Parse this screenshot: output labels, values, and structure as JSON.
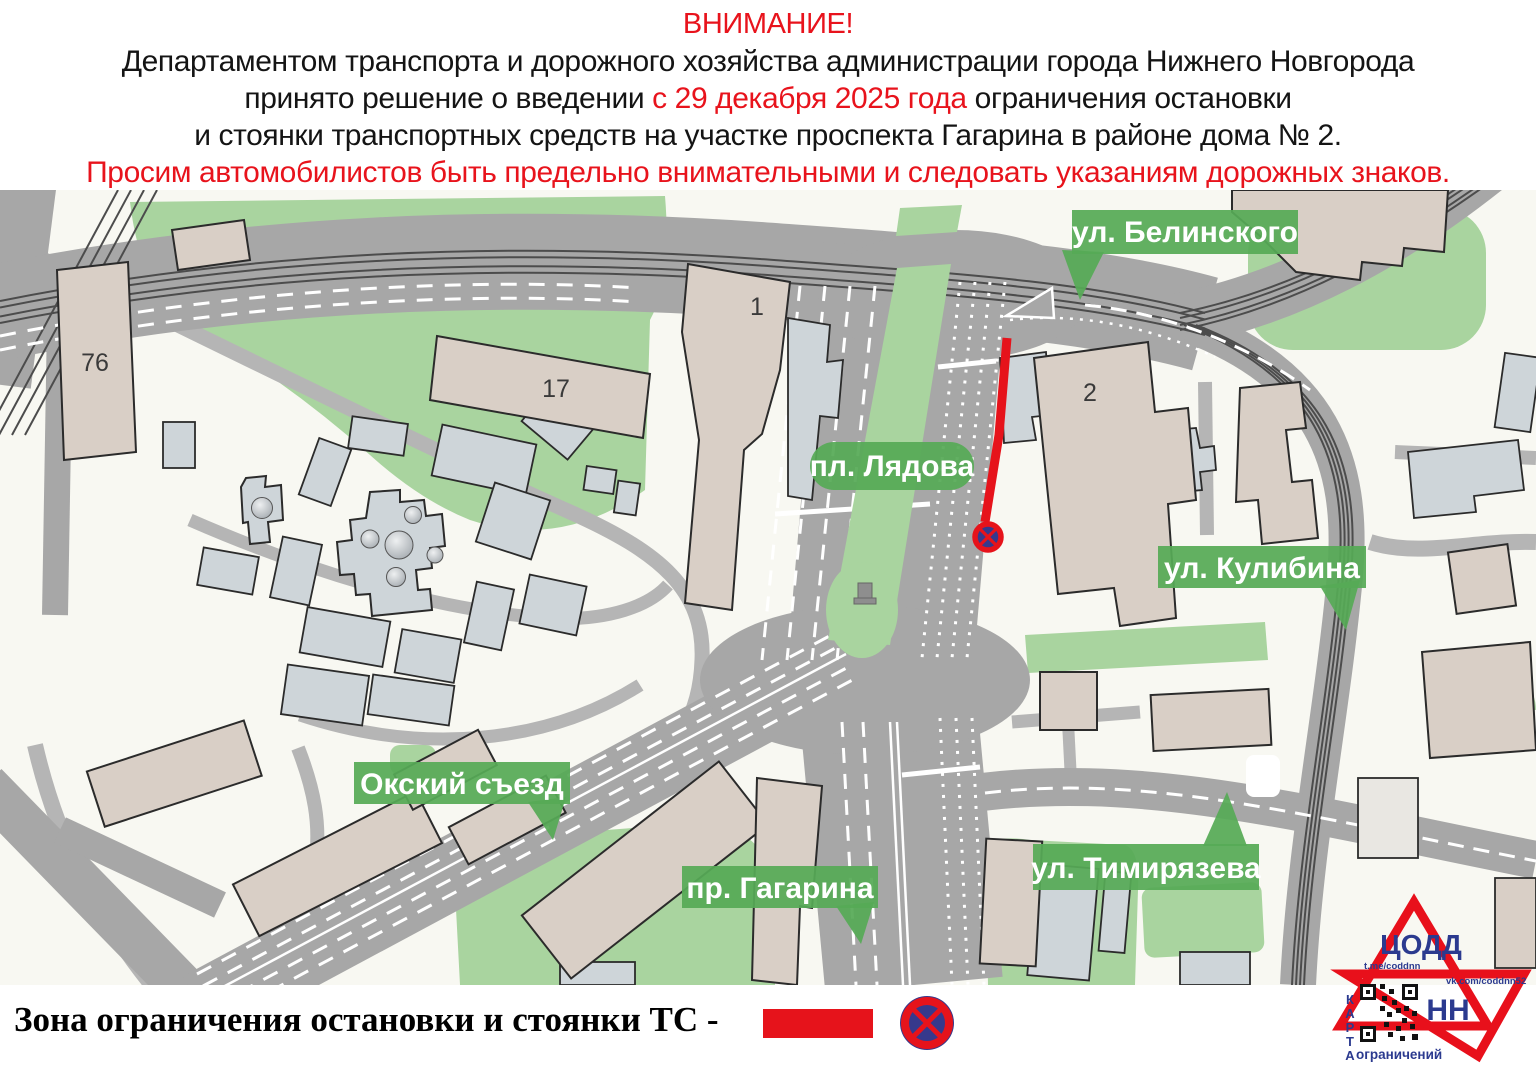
{
  "header": {
    "title": "ВНИМАНИЕ!",
    "line1": "Департаментом транспорта и дорожного хозяйства администрации города Нижнего Новгорода",
    "line2_before": "принято решение о введении ",
    "line2_red": "с 29 декабря 2025 года",
    "line2_after": " ограничения остановки",
    "line3": "и стоянки транспортных средств на участке проспекта Гагарина в районе дома № 2.",
    "line4": "Просим автомобилистов быть предельно внимательными и следовать указаниям дорожных знаков."
  },
  "map": {
    "labels": {
      "belinskogo": "ул. Белинского",
      "lyadova": "пл. Лядова",
      "kulibina": "ул. Кулибина",
      "oksky": "Окский съезд",
      "gagarina": "пр. Гагарина",
      "timiryazeva": "ул. Тимирязева"
    },
    "buildings": {
      "b76": "76",
      "b17": "17",
      "b1": "1",
      "b2": "2"
    },
    "colors": {
      "restriction_red": "#e6131b",
      "label_green": "#56aa56",
      "park_green": "#a9d49f",
      "road_gray": "#a7a7a7",
      "sign_blue": "#36398c"
    }
  },
  "legend": {
    "label": "Зона ограничения остановки и стоянки ТС -"
  },
  "logo": {
    "org": "ЦОДД",
    "city": "НН",
    "telegram": "t.me/coddnn",
    "vk": "vk.com/coddnn52",
    "karta": "КАРТА",
    "restrictions": "ограничений"
  }
}
